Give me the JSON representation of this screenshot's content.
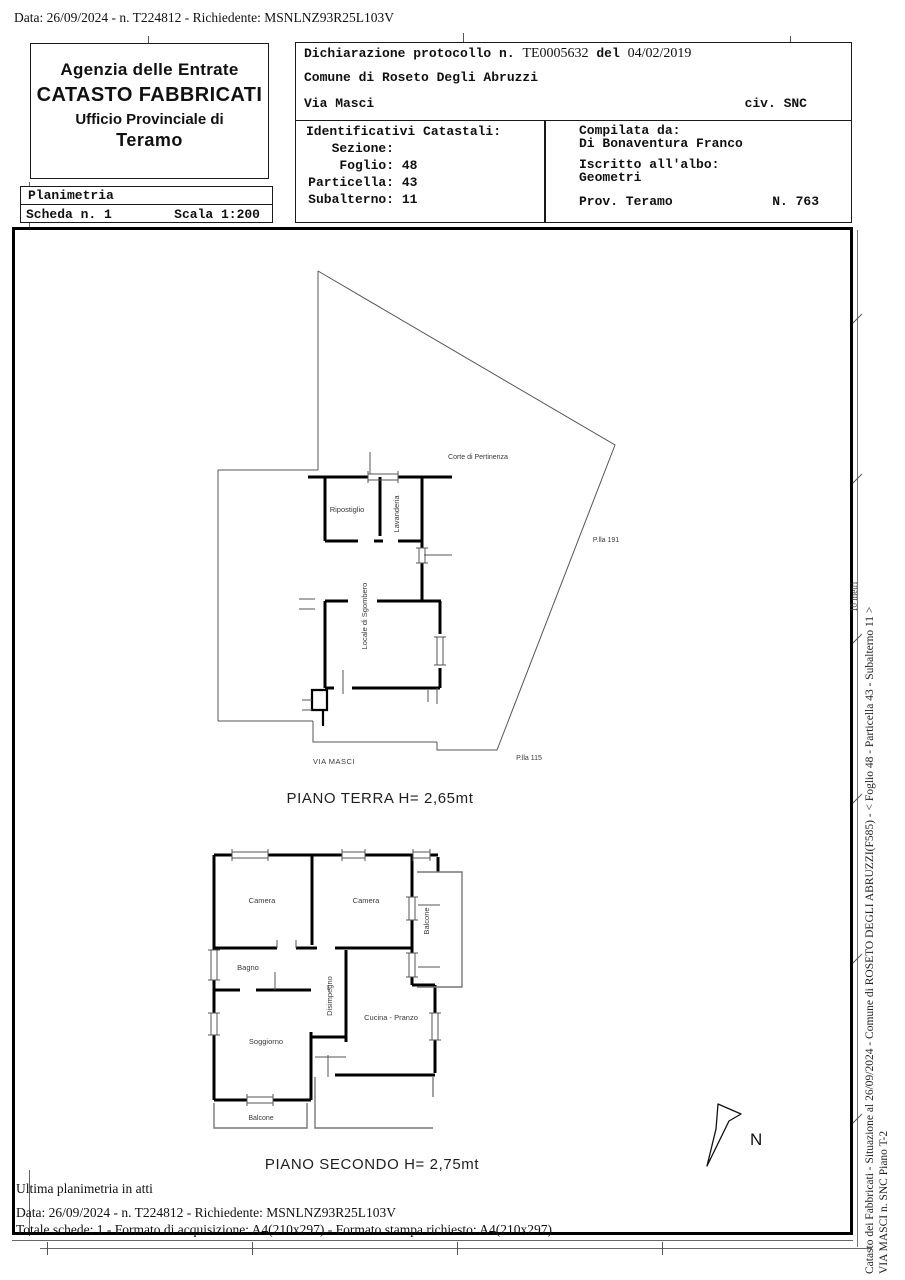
{
  "page": {
    "top_line": "Data: 26/09/2024 - n. T224812 - Richiedente: MSNLNZ93R25L103V"
  },
  "header": {
    "agency": {
      "line1": "Agenzia delle Entrate",
      "line2": "CATASTO FABBRICATI",
      "line3": "Ufficio Provinciale di",
      "line4": "Teramo"
    },
    "planimetria": {
      "title": "Planimetria",
      "scheda": "Scheda n. 1",
      "scala": "Scala 1:200"
    },
    "declaration": {
      "label": "Dichiarazione protocollo n.",
      "protocol": "TE0005632",
      "del": "del",
      "date": "04/02/2019",
      "comune": "Comune di Roseto Degli Abruzzi",
      "street": "Via Masci",
      "civ": "civ. SNC"
    },
    "identificativi": {
      "title": "Identificativi Catastali:",
      "rows": [
        {
          "label": "Sezione:",
          "value": ""
        },
        {
          "label": "Foglio:",
          "value": "48"
        },
        {
          "label": "Particella:",
          "value": "43"
        },
        {
          "label": "Subalterno:",
          "value": "11"
        }
      ]
    },
    "compilata": {
      "title": "Compilata da:",
      "name": "Di Bonaventura Franco",
      "albo_label": "Iscritto all'albo:",
      "albo": "Geometri",
      "prov": "Prov. Teramo",
      "number": "N. 763"
    }
  },
  "plan": {
    "ground": {
      "title": "PIANO TERRA H= 2,65mt",
      "labels": {
        "corte": "Corte di Pertinenza",
        "ripostiglio": "Ripostiglio",
        "lavanderia": "Lavanderia",
        "locale": "Locale di Sgombero",
        "plla191": "P.lla 191",
        "plla115": "P.lla 115",
        "via": "VIA MASCI"
      }
    },
    "second": {
      "title": "PIANO SECONDO H= 2,75mt",
      "labels": {
        "camera1": "Camera",
        "camera2": "Camera",
        "balcone_right": "Balcone",
        "bagno": "Bagno",
        "disimpegno": "Disimpegno",
        "cucina": "Cucina - Pranzo",
        "soggiorno": "Soggiorno",
        "balcone_bottom": "Balcone"
      }
    },
    "north_label": "N",
    "scale_note": "10 metri"
  },
  "sidebar": {
    "line1": "Catasto dei Fabbricati - Situazione al 26/09/2024 - Comune di ROSETO DEGLI ABRUZZI(F585) - <  Foglio 48 - Particella  43 - Subalterno 11 >",
    "line2": "VIA MASCI n. SNC Piano T-2"
  },
  "footer": {
    "line1": "Ultima planimetria in atti",
    "line2": "Data: 26/09/2024 - n. T224812 - Richiedente: MSNLNZ93R25L103V",
    "line3": "Totale schede: 1 - Formato di acquisizione: A4(210x297)  - Formato stampa richiesto: A4(210x297)"
  }
}
